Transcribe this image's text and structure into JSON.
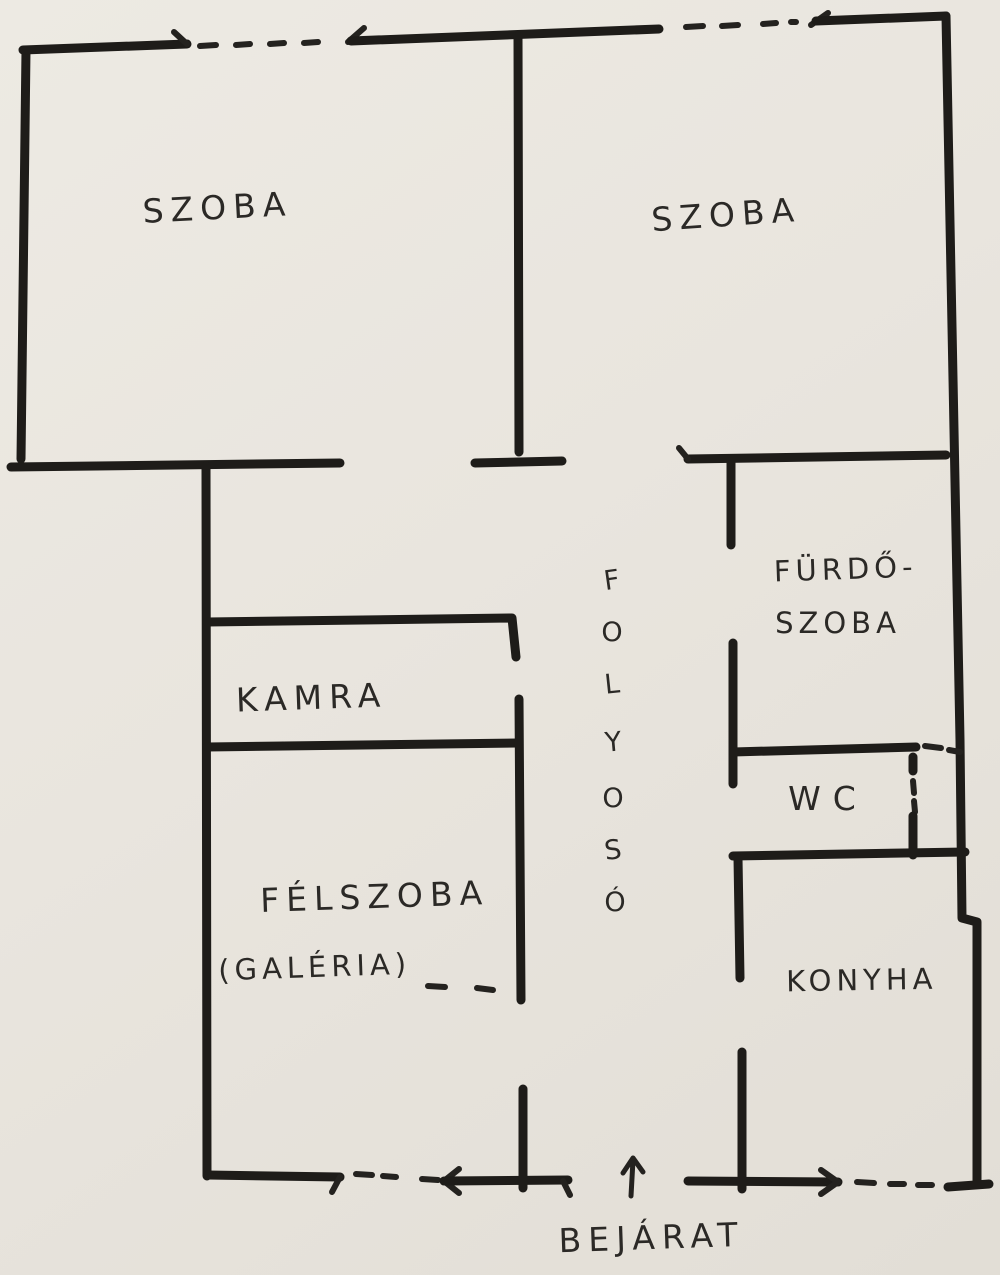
{
  "document": {
    "kind": "hand-drawn apartment floor plan sketch",
    "language": "Hungarian"
  },
  "colors": {
    "paper": "#e9e5de",
    "ink": "#1e1c19"
  },
  "rooms": [
    {
      "id": "szoba-top-left",
      "label": "SZOBA"
    },
    {
      "id": "szoba-top-right",
      "label": "SZOBA"
    },
    {
      "id": "furdoszoba",
      "label_line1": "FÜRDŐ-",
      "label_line2": "SZOBA"
    },
    {
      "id": "kamra",
      "label": "KAMRA"
    },
    {
      "id": "wc",
      "label": "WC"
    },
    {
      "id": "felszoba",
      "label": "FÉLSZOBA",
      "sublabel": "(GALÉRIA)"
    },
    {
      "id": "konyha",
      "label": "KONYHA"
    }
  ],
  "corridor": {
    "label": "FOLYOSÓ",
    "letters": [
      "F",
      "O",
      "L",
      "Y",
      "O",
      "S",
      "Ó"
    ]
  },
  "entrance": {
    "label": "BEJÁRAT"
  }
}
